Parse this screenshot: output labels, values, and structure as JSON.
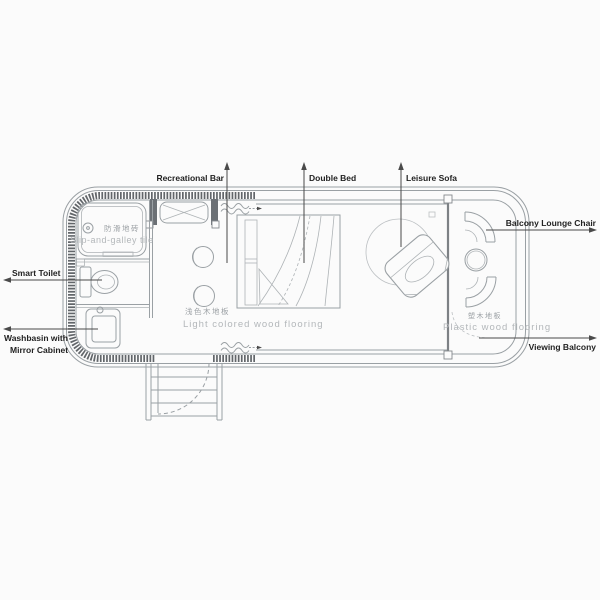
{
  "labels": {
    "recreational_bar": "Recreational Bar",
    "double_bed": "Double Bed",
    "leisure_sofa": "Leisure Sofa",
    "balcony_lounge_chair": "Balcony Lounge Chair",
    "viewing_balcony": "Viewing Balcony",
    "smart_toilet": "Smart Toilet",
    "washbasin_line1": "Washbasin with",
    "washbasin_line2": "Mirror Cabinet"
  },
  "floor_texts": {
    "bathroom_cn": "防滑地砖",
    "bathroom_en": "Slip-and-galley tile",
    "interior_cn": "浅色木地板",
    "interior_en": "Light colored wood flooring",
    "balcony_cn": "塑木地板",
    "balcony_en": "Plastic wood flooring"
  },
  "colors": {
    "background": "#fbfbfb",
    "wall_dark": "#62666a",
    "line_gray": "#9aa0a4",
    "floor_text_gray": "#b3b7ba",
    "label_text": "#222222"
  }
}
